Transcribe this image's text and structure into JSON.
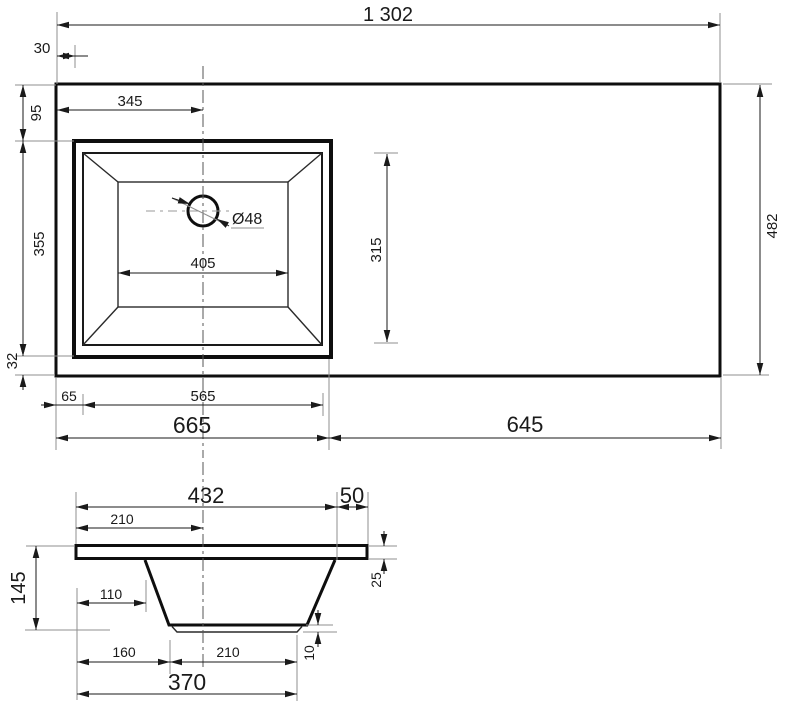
{
  "drawing": {
    "background": "#ffffff",
    "line_color": "#0e0e0e",
    "dim_color": "#1a1a1a",
    "ext_color": "#8f8f8f"
  },
  "top_view": {
    "total_width": "1 302",
    "left_edge_offset": "30",
    "drain_center_from_left": "345",
    "front_margin": "95",
    "sink_cutout_depth": "355",
    "back_margin": "32",
    "counter_depth": "482",
    "basin_inner_depth": "315",
    "rim_offset": "65",
    "rim_width": "565",
    "left_section_width": "665",
    "right_section_width": "645",
    "drain_diameter": "Ø48",
    "basin_bottom_width": "405"
  },
  "section_view": {
    "bowl_top_width": "432",
    "right_offset": "50",
    "center_offset": "210",
    "total_height": "145",
    "wall_top_offset": "110",
    "slab_thickness": "25",
    "bottom_left_offset": "160",
    "bottom_width": "210",
    "pad_thickness": "10",
    "bottom_overall_width": "370"
  }
}
